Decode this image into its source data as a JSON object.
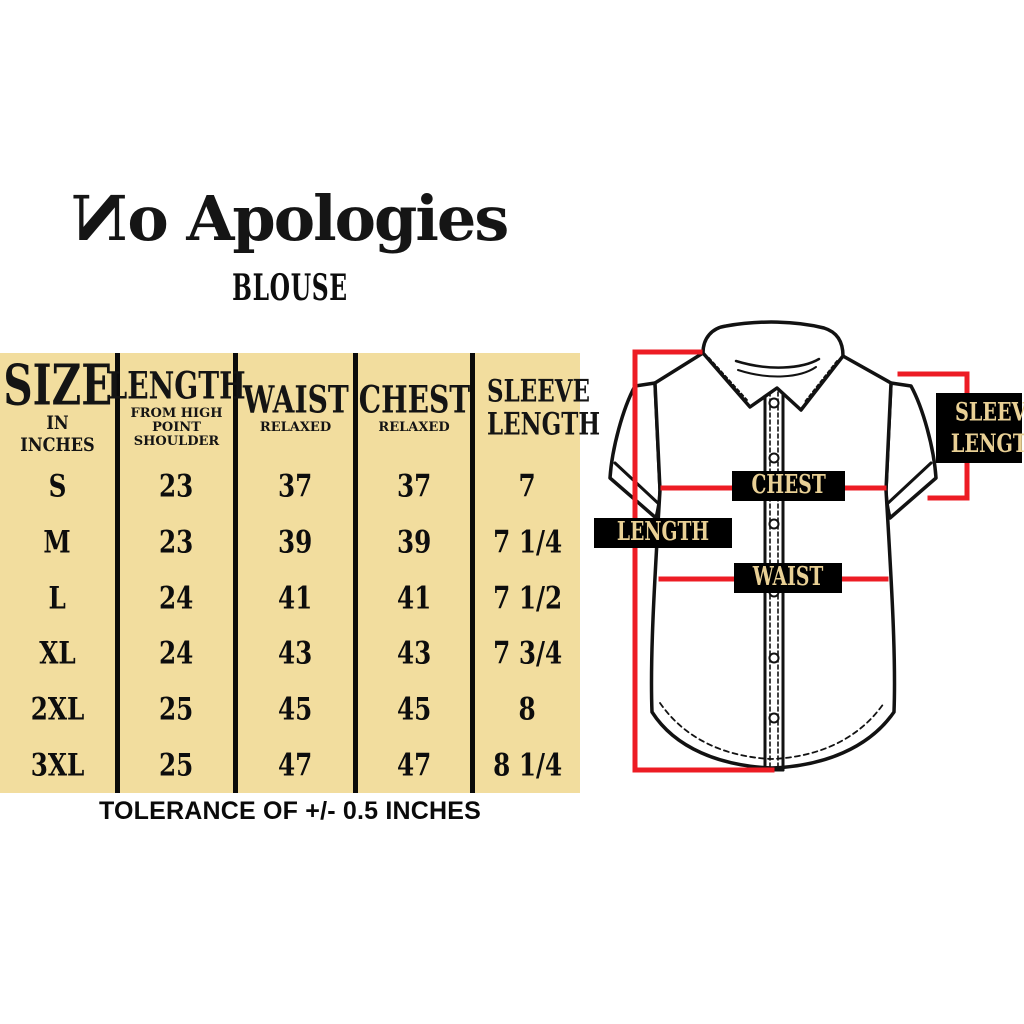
{
  "brand": {
    "name": "No Apologies"
  },
  "page": {
    "product_title": "BLOUSE",
    "tolerance_note": "TOLERANCE OF +/- 0.5 INCHES"
  },
  "colors": {
    "table_background": "#f2dd9e",
    "divider_black": "#0b0b0b",
    "measure_red": "#ed1c24",
    "label_background": "#000000",
    "label_text": "#e9d095"
  },
  "chart_data": {
    "type": "table",
    "title": "BLOUSE",
    "unit": "IN INCHES",
    "columns": [
      {
        "label": "SIZE",
        "sub": "IN INCHES"
      },
      {
        "label": "LENGTH",
        "sub": "FROM HIGH POINT SHOULDER"
      },
      {
        "label": "WAIST",
        "sub": "RELAXED"
      },
      {
        "label": "CHEST",
        "sub": "RELAXED"
      },
      {
        "label": "SLEEVE LENGTH",
        "sub": ""
      }
    ],
    "rows": [
      [
        "S",
        "23",
        "37",
        "37",
        "7"
      ],
      [
        "M",
        "23",
        "39",
        "39",
        "7 1/4"
      ],
      [
        "L",
        "24",
        "41",
        "41",
        "7 1/2"
      ],
      [
        "XL",
        "24",
        "43",
        "43",
        "7 3/4"
      ],
      [
        "2XL",
        "25",
        "45",
        "45",
        "8"
      ],
      [
        "3XL",
        "25",
        "47",
        "47",
        "8 1/4"
      ]
    ],
    "footnote": "TOLERANCE OF +/- 0.5 INCHES"
  },
  "diagram": {
    "labels": {
      "length": "LENGTH",
      "chest": "CHEST",
      "waist": "WAIST",
      "sleeve_length": "SLEEVE LENGTH"
    }
  }
}
